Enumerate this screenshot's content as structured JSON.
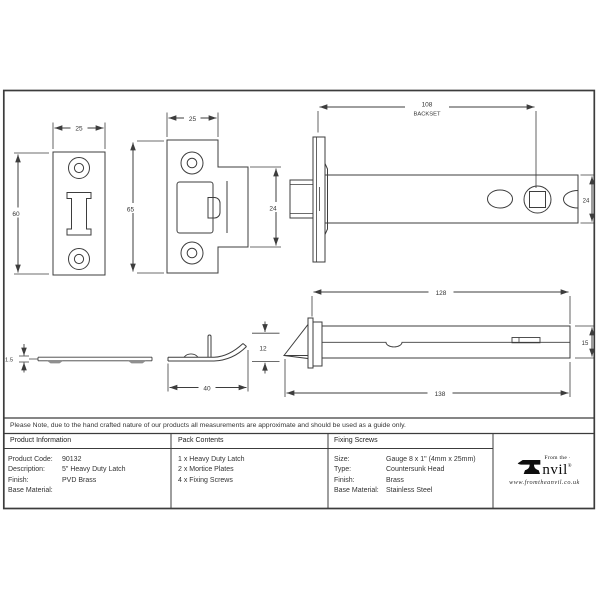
{
  "note": "Please Note, due to the hand crafted nature of our products all measurements are approximate and should be used as a guide only.",
  "drawing": {
    "faceplate_front": {
      "width": "25",
      "height": "60"
    },
    "keep_front": {
      "width": "25",
      "height": "65",
      "tab_height": "24"
    },
    "latch_side": {
      "backset_value": "108",
      "backset_label": "BACKSET",
      "height": "24"
    },
    "plate_edge": {
      "thickness": "1.5"
    },
    "keep_edge": {
      "length": "40",
      "height": "12"
    },
    "latch_top": {
      "case_length": "128",
      "width": "15",
      "overall_length": "138"
    }
  },
  "table": {
    "product_information": {
      "header": "Product Information",
      "rows": [
        {
          "label": "Product Code:",
          "value": "90132"
        },
        {
          "label": "Description:",
          "value": "5\" Heavy Duty Latch"
        },
        {
          "label": "Finish:",
          "value": "PVD Brass"
        },
        {
          "label": "Base Material:",
          "value": ""
        }
      ]
    },
    "pack_contents": {
      "header": "Pack Contents",
      "items": [
        "1 x Heavy Duty Latch",
        "2 x Mortice Plates",
        "4 x Fixing Screws"
      ]
    },
    "fixing_screws": {
      "header": "Fixing Screws",
      "rows": [
        {
          "label": "Size:",
          "value": "Gauge 8 x 1\" (4mm x 25mm)"
        },
        {
          "label": "Type:",
          "value": "Countersunk Head"
        },
        {
          "label": "Finish:",
          "value": "Brass"
        },
        {
          "label": "Base Material:",
          "value": "Stainless Steel"
        }
      ]
    },
    "brand": {
      "tagline": "From the",
      "mark": "·",
      "name": "nvil",
      "reg": "®",
      "website": "www.fromtheanvil.co.uk"
    }
  }
}
